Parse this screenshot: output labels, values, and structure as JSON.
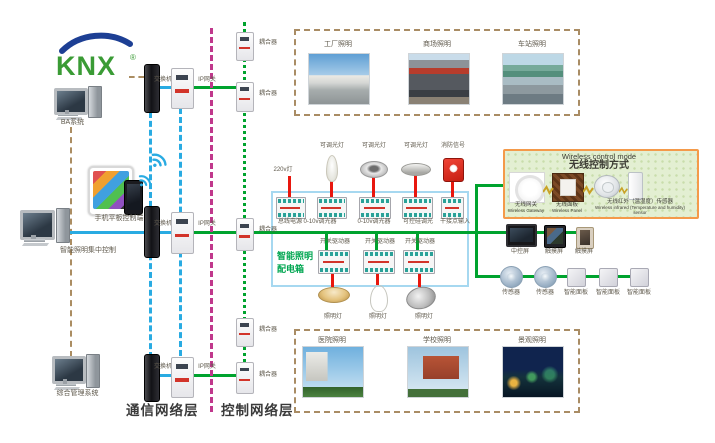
{
  "logo": {
    "text": "KNX",
    "reg": "®"
  },
  "left_column": {
    "pc1": "BA系统",
    "mobile": "手机平板控制端",
    "pc2": "智能照明集中控制",
    "pc3": "综合管理系统"
  },
  "layers": {
    "comm": "通信网络层",
    "ctrl": "控制网络层"
  },
  "net": {
    "switches": [
      "交换机",
      "交换机",
      "交换机"
    ],
    "gateways": [
      "IP网关",
      "IP网关",
      "IP网关"
    ],
    "couplers": [
      "耦合器",
      "耦合器",
      "耦合器",
      "耦合器",
      "耦合器"
    ]
  },
  "box": {
    "title1": "智能照明",
    "title2": "配电箱",
    "loads_top": [
      "220v灯",
      "可调光灯",
      "可调光灯",
      "可调光灯",
      "消防信号"
    ],
    "modules_top": [
      "总线电源",
      "0-10v调光器",
      "0-10v调光器",
      "可控硅调光",
      "干接点输入"
    ],
    "modules_bottom": [
      "开关驱动器",
      "开关驱动器",
      "开关驱动器"
    ],
    "loads_bottom": [
      "照明灯",
      "照明灯",
      "照明灯"
    ]
  },
  "wireless": {
    "title_en": "Wireless control mode",
    "title_cn": "无线控制方式",
    "items": [
      {
        "cn": "无线网关",
        "en": "Wireless Gateway"
      },
      {
        "cn": "无线面板",
        "en": "Wireless Panel"
      },
      {
        "cn": "无线红外（温湿度）传感器",
        "en": "Wireless infrared (Temperature and humidity) sensor"
      }
    ]
  },
  "right": {
    "row1": [
      "中控屏",
      "触摸屏",
      "触摸屏"
    ],
    "row2": [
      "传感器",
      "传感器",
      "智能面板",
      "智能面板",
      "智能面板"
    ]
  },
  "photos": {
    "top": [
      "工厂照明",
      "商场照明",
      "车站照明"
    ],
    "bottom": [
      "医院照明",
      "学校照明",
      "景观照明"
    ]
  },
  "colors": {
    "bus_green": "#00a32e",
    "lan_blue": "#29abe2",
    "separator_magenta": "#c0388c",
    "mgmt_tan": "#ab8d62",
    "load_red": "#e8170e",
    "wireless_border": "#f49a4a",
    "box_border": "#a6d8f0",
    "logo_green": "#3a9b35",
    "logo_blue": "#1d3f94"
  }
}
